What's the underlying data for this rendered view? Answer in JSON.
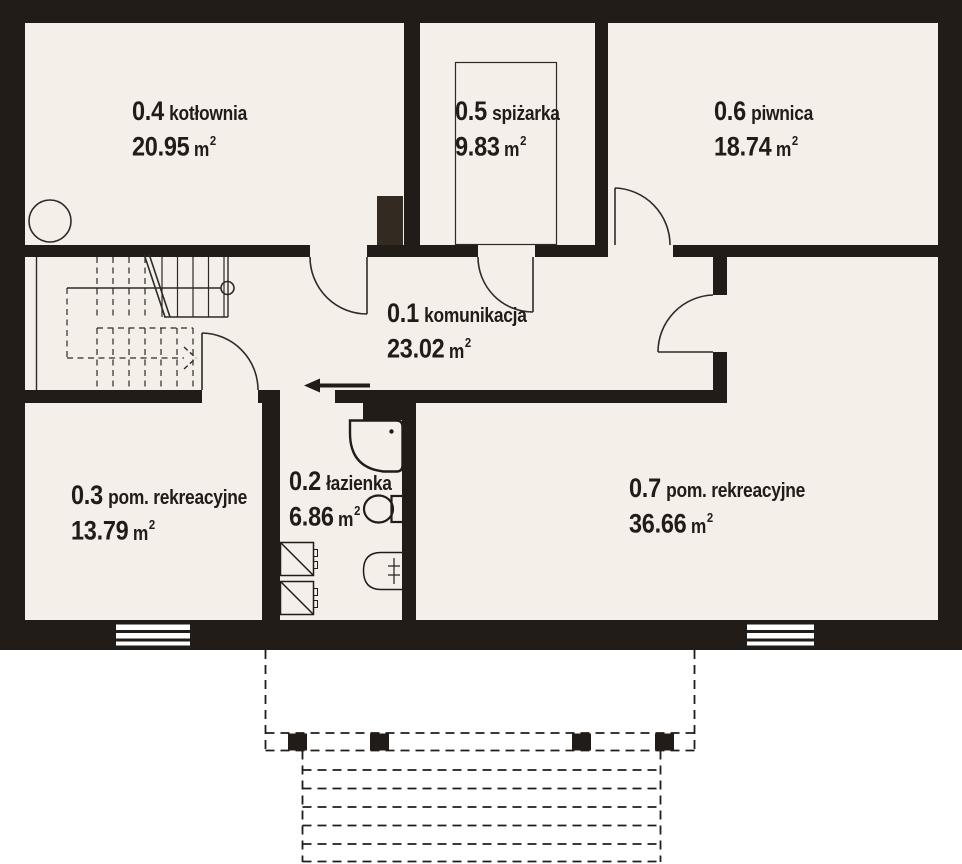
{
  "plan_title": "basement floor plan",
  "unit": {
    "symbol": "m",
    "exponent": "2"
  },
  "colors": {
    "wall": "#211c18",
    "floor": "#f4efe9",
    "background": "#ffffff",
    "line": "#2e2a26"
  },
  "rooms": [
    {
      "number": "0.1",
      "name": "komunikacja",
      "area": "23.02"
    },
    {
      "number": "0.2",
      "name": "łazienka",
      "area": "6.86"
    },
    {
      "number": "0.3",
      "name": "pom. rekreacyjne",
      "area": "13.79"
    },
    {
      "number": "0.4",
      "name": "kotłownia",
      "area": "20.95"
    },
    {
      "number": "0.5",
      "name": "spiżarka",
      "area": "9.83"
    },
    {
      "number": "0.6",
      "name": "piwnica",
      "area": "18.74"
    },
    {
      "number": "0.7",
      "name": "pom. rekreacyjne",
      "area": "36.66"
    }
  ],
  "symbols": [
    "stairs",
    "boiler",
    "chimney",
    "pantry-shelf",
    "shower",
    "toilet",
    "washbasin",
    "washer",
    "window",
    "door",
    "terrace",
    "exterior-steps",
    "entrance-arrow"
  ]
}
